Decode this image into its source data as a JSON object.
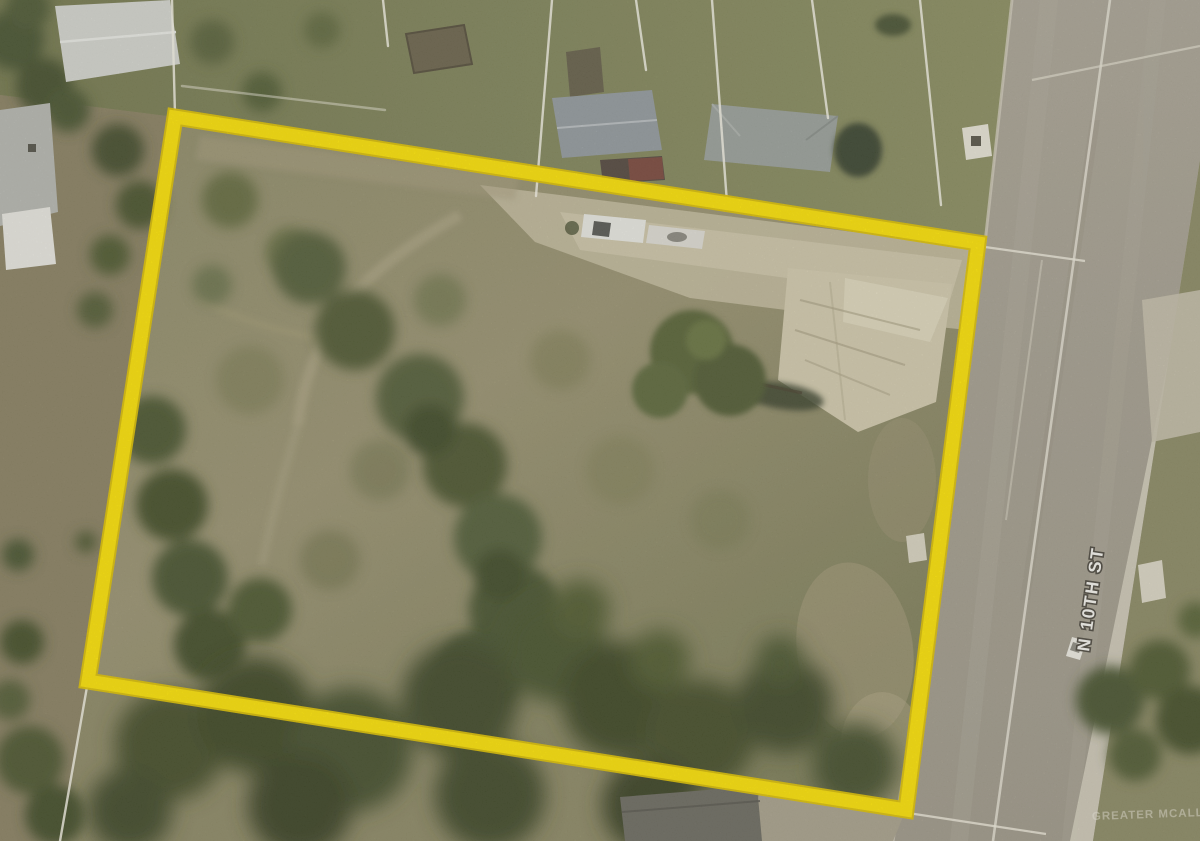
{
  "map": {
    "street_label": "N 10TH ST",
    "watermark": "GREATER MCALLEN",
    "colors": {
      "boundary_yellow": "#fde405",
      "boundary_yellow_edge": "#dfc200",
      "parcel_line_white": "#f4f1e4",
      "road_gray": "#a7a192",
      "lawn_green": "#7e8254",
      "scrub_tan": "#94906c",
      "dense_brush_green": "#46502c",
      "sand_tan": "#d3cbae"
    }
  }
}
